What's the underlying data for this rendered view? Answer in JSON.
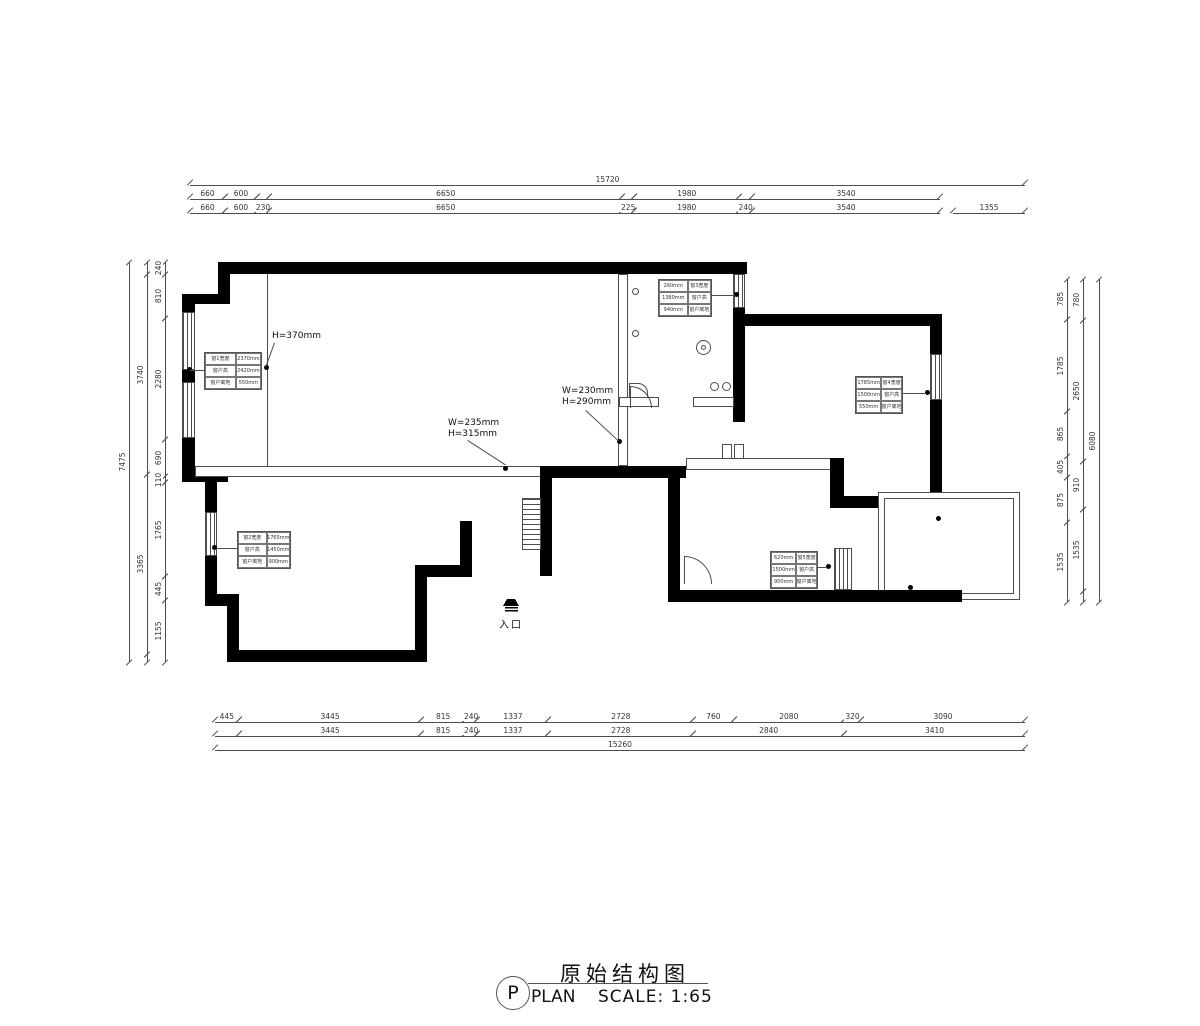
{
  "title_block": {
    "letter": "P",
    "title_cn": "原始结构图",
    "title_en": "PLAN",
    "scale": "SCALE: 1:65"
  },
  "entry_label": "入口",
  "annotations": {
    "h370": {
      "line1": "H=370mm"
    },
    "w235": {
      "line1": "W=235mm",
      "line2": "H=315mm"
    },
    "w230": {
      "line1": "W=230mm",
      "line2": "H=290mm"
    }
  },
  "dims": {
    "top_overall": [
      {
        "mm": 15720,
        "t": "15720"
      }
    ],
    "top_row1": [
      {
        "mm": 660,
        "t": "660"
      },
      {
        "mm": 600,
        "t": "600"
      },
      {
        "mm": 230
      },
      {
        "mm": 6650,
        "t": "6650"
      },
      {
        "mm": 225
      },
      {
        "mm": 1980,
        "t": "1980"
      },
      {
        "mm": 240
      },
      {
        "mm": 3540,
        "t": "3540"
      }
    ],
    "top_row2": [
      {
        "mm": 660,
        "t": "660"
      },
      {
        "mm": 600,
        "t": "600"
      },
      {
        "mm": 230,
        "t": "230"
      },
      {
        "mm": 6650,
        "t": "6650"
      },
      {
        "mm": 225,
        "t": "225"
      },
      {
        "mm": 1980,
        "t": "1980"
      },
      {
        "mm": 240,
        "t": "240"
      },
      {
        "mm": 3540,
        "t": "3540"
      }
    ],
    "top_1355": [
      {
        "mm": 1355,
        "t": "1355"
      }
    ],
    "bottom_row1": [
      {
        "mm": 445,
        "t": "445"
      },
      {
        "mm": 3445,
        "t": "3445"
      },
      {
        "mm": 815,
        "t": "815"
      },
      {
        "mm": 240,
        "t": "240"
      },
      {
        "mm": 1337,
        "t": "1337"
      },
      {
        "mm": 2728,
        "t": "2728"
      },
      {
        "mm": 760,
        "t": "760"
      },
      {
        "mm": 2080,
        "t": "2080"
      },
      {
        "mm": 320,
        "t": "320"
      },
      {
        "mm": 3090,
        "t": "3090"
      }
    ],
    "bottom_row2": [
      {
        "mm": 445
      },
      {
        "mm": 3445,
        "t": "3445"
      },
      {
        "mm": 815,
        "t": "815"
      },
      {
        "mm": 240,
        "t": "240"
      },
      {
        "mm": 1337,
        "t": "1337"
      },
      {
        "mm": 2728,
        "t": "2728"
      },
      {
        "mm": 2840,
        "t": "2840"
      },
      {
        "mm": 3410,
        "t": "3410"
      }
    ],
    "bottom_overall": [
      {
        "mm": 15260,
        "t": "15260"
      }
    ],
    "left_inner": [
      {
        "mm": 240,
        "t": "240"
      },
      {
        "mm": 810,
        "t": "810"
      },
      {
        "mm": 2280,
        "t": "2280"
      },
      {
        "mm": 690,
        "t": "690"
      },
      {
        "mm": 110,
        "t": "110"
      },
      {
        "mm": 1765,
        "t": "1765"
      },
      {
        "mm": 445,
        "t": "445"
      },
      {
        "mm": 1155,
        "t": "1155"
      }
    ],
    "left_mid": [
      {
        "mm": 240
      },
      {
        "mm": 3740,
        "t": "3740"
      },
      {
        "mm": 3365,
        "t": "3365"
      },
      {
        "mm": 150
      }
    ],
    "left_overall": [
      {
        "mm": 7475,
        "t": "7475"
      }
    ],
    "right_inner": [
      {
        "mm": 785,
        "t": "785"
      },
      {
        "mm": 1785,
        "t": "1785"
      },
      {
        "mm": 865,
        "t": "865"
      },
      {
        "mm": 405,
        "t": "405"
      },
      {
        "mm": 875,
        "t": "875"
      },
      {
        "mm": 1535,
        "t": "1535"
      }
    ],
    "right_mid": [
      {
        "mm": 780,
        "t": "780"
      },
      {
        "mm": 2650,
        "t": "2650"
      },
      {
        "mm": 910,
        "t": "910"
      },
      {
        "mm": 1535,
        "t": "1535"
      },
      {
        "mm": 205
      }
    ],
    "right_overall": [
      {
        "mm": 6080,
        "t": "6080"
      }
    ]
  },
  "tables": {
    "left_top": {
      "rows": [
        [
          "窗1宽度",
          "2370mm"
        ],
        [
          "窗户高",
          "2420mm"
        ],
        [
          "窗户离地",
          "550mm"
        ]
      ]
    },
    "left_bottom": {
      "rows": [
        [
          "窗2宽度",
          "1765mm"
        ],
        [
          "窗户高",
          "1450mm"
        ],
        [
          "窗户离地",
          "900mm"
        ]
      ]
    },
    "bath": {
      "rows": [
        [
          "260mm",
          "窗3宽度"
        ],
        [
          "1380mm",
          "窗户高"
        ],
        [
          "940mm",
          "窗户离地"
        ]
      ]
    },
    "right": {
      "rows": [
        [
          "1785mm",
          "窗4宽度"
        ],
        [
          "1500mm",
          "窗户高"
        ],
        [
          "550mm",
          "窗户离地"
        ]
      ]
    },
    "bottom_right": {
      "rows": [
        [
          "620mm",
          "窗5宽度"
        ],
        [
          "1500mm",
          "窗户高"
        ],
        [
          "900mm",
          "窗户离地"
        ]
      ]
    }
  }
}
